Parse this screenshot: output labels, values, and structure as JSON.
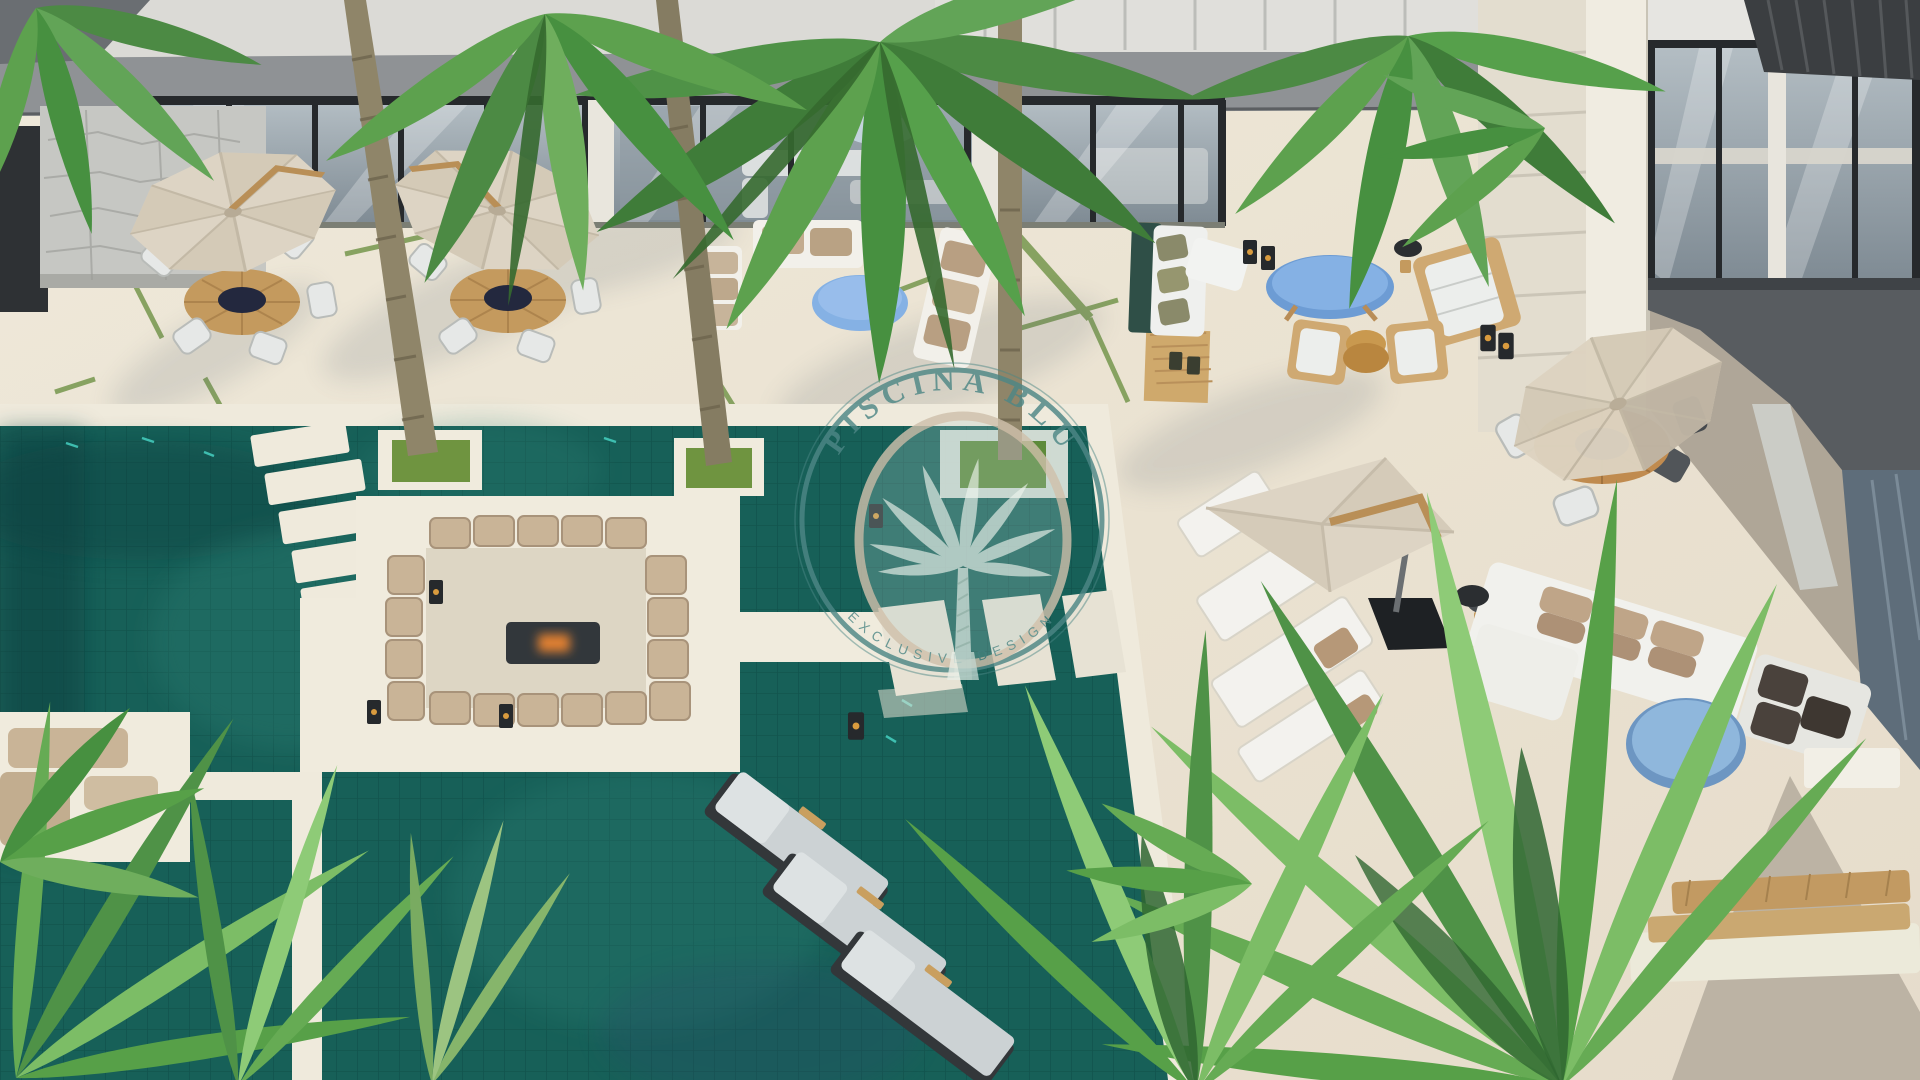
{
  "watermark": {
    "title": "PISCINA BLU",
    "tagline": "EXCLUSIVE DESIGN",
    "emblem": "palm-tree-icon"
  },
  "palette": {
    "deck": "#ebe4d3",
    "deck_shadow": "#a9a193",
    "pool": "#176058",
    "pool_grout": "#0d4a43",
    "pool_dark": "#0b4141",
    "pool_light": "#2d8176",
    "sparkle": "#49d8c8",
    "coping": "#efeadc",
    "platform_white": "#f0ebdd",
    "canopy_beige": "#ddd4c4",
    "cushion_beige": "#c9b497",
    "cushion_dark": "#4a423c",
    "pillow_olive": "#8a8a6a",
    "wood_teak": "#c49a5e",
    "table_blue": "#85b1e4",
    "spa_blue": "#8fb7dc",
    "palm_green": "#5da14e",
    "palm_green_light": "#8ecb77",
    "palm_green_dark": "#35692f",
    "grass_joint": "#7d9b55",
    "glass": "#a9b3ba",
    "frame_dark": "#26292c",
    "roof_gray": "#8f9295",
    "roof_dark": "#3b3e41",
    "fire_glow": "#e08030",
    "watermark_teal": "#4d8786",
    "watermark_beige": "#cfc0ab"
  }
}
